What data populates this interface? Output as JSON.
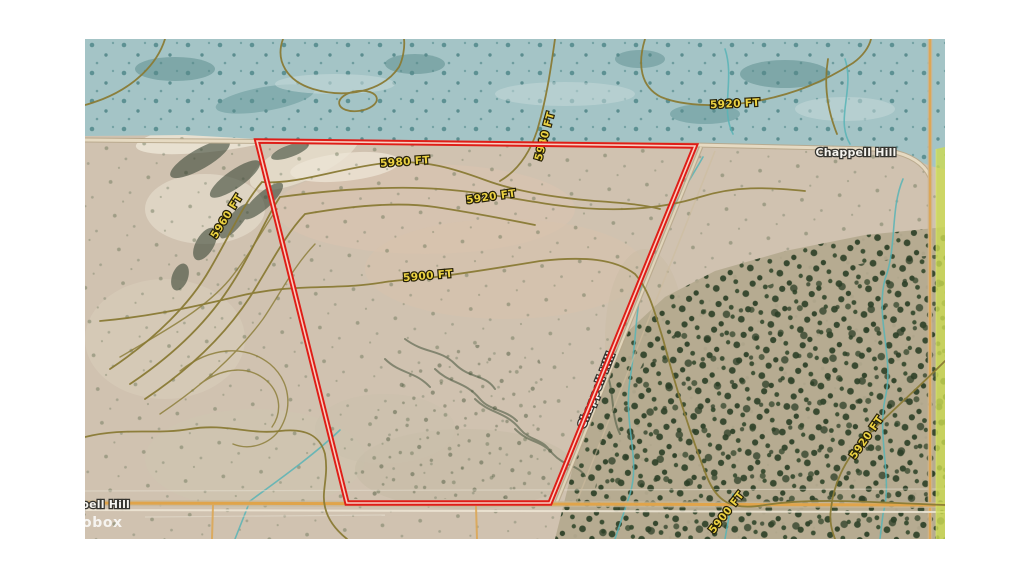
{
  "map": {
    "labels": {
      "contour_5920_top": "5920 FT",
      "contour_5980": "5980 FT",
      "contour_5940": "5940 FT",
      "contour_5920_mid": "5920 FT",
      "contour_5960": "5960 FT",
      "contour_5900_mid": "5900 FT",
      "contour_5920_se": "5920 FT",
      "contour_5900_se": "5900 FT",
      "road_top": "Chappell Hill",
      "road_diagonal": "Chappell Hill",
      "road_bottom_partial": "pell Hill",
      "watermark_partial": "obox"
    },
    "colors": {
      "parcel_boundary": "#df1d17",
      "parcel_boundary_core": "#f8cfc2",
      "contour_line": "#8a7b35",
      "contour_label": "#ecd243",
      "road_label": "#f6f4ef",
      "overlay_teal": "#a4c4c6",
      "terrain_tan": "#d0c2b0",
      "vegetation": "#33452c",
      "stream": "#58b4b6",
      "road_orange": "#e0a44a",
      "edge_band": "#ccdb52"
    }
  }
}
